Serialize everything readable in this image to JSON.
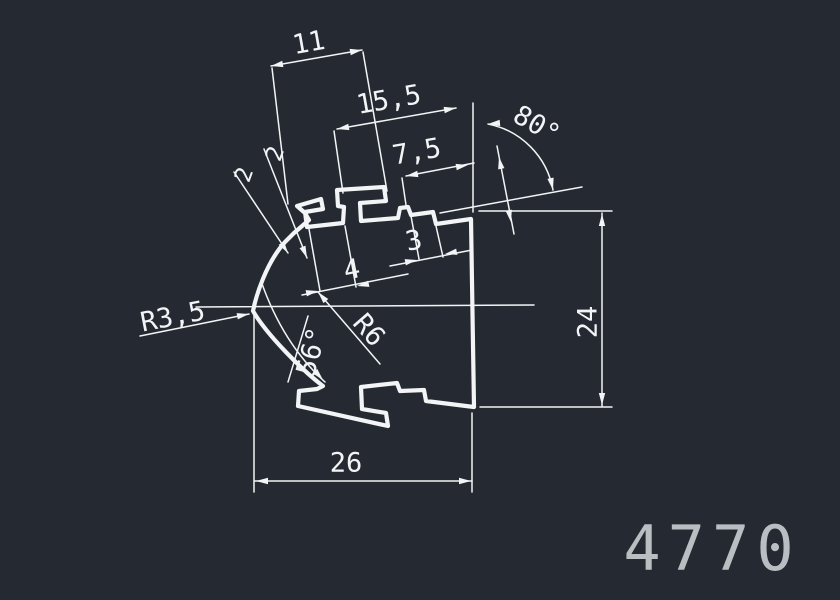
{
  "canvas": {
    "background_color": "#252a32",
    "line_color": "#f2f4f6",
    "part_number_color": "#b9bec3"
  },
  "part_number": "4770",
  "dimensions": {
    "top_width": "11",
    "upper_width": "15,5",
    "notch_width": "7,5",
    "lip_a": "2",
    "lip_b": "2",
    "slot_width": "4",
    "step_height": "3",
    "top_angle": "80°",
    "sweep_angle": "56°",
    "tip_radius": "R3,5",
    "side_radius": "R6",
    "height": "24",
    "bottom_width": "26"
  }
}
